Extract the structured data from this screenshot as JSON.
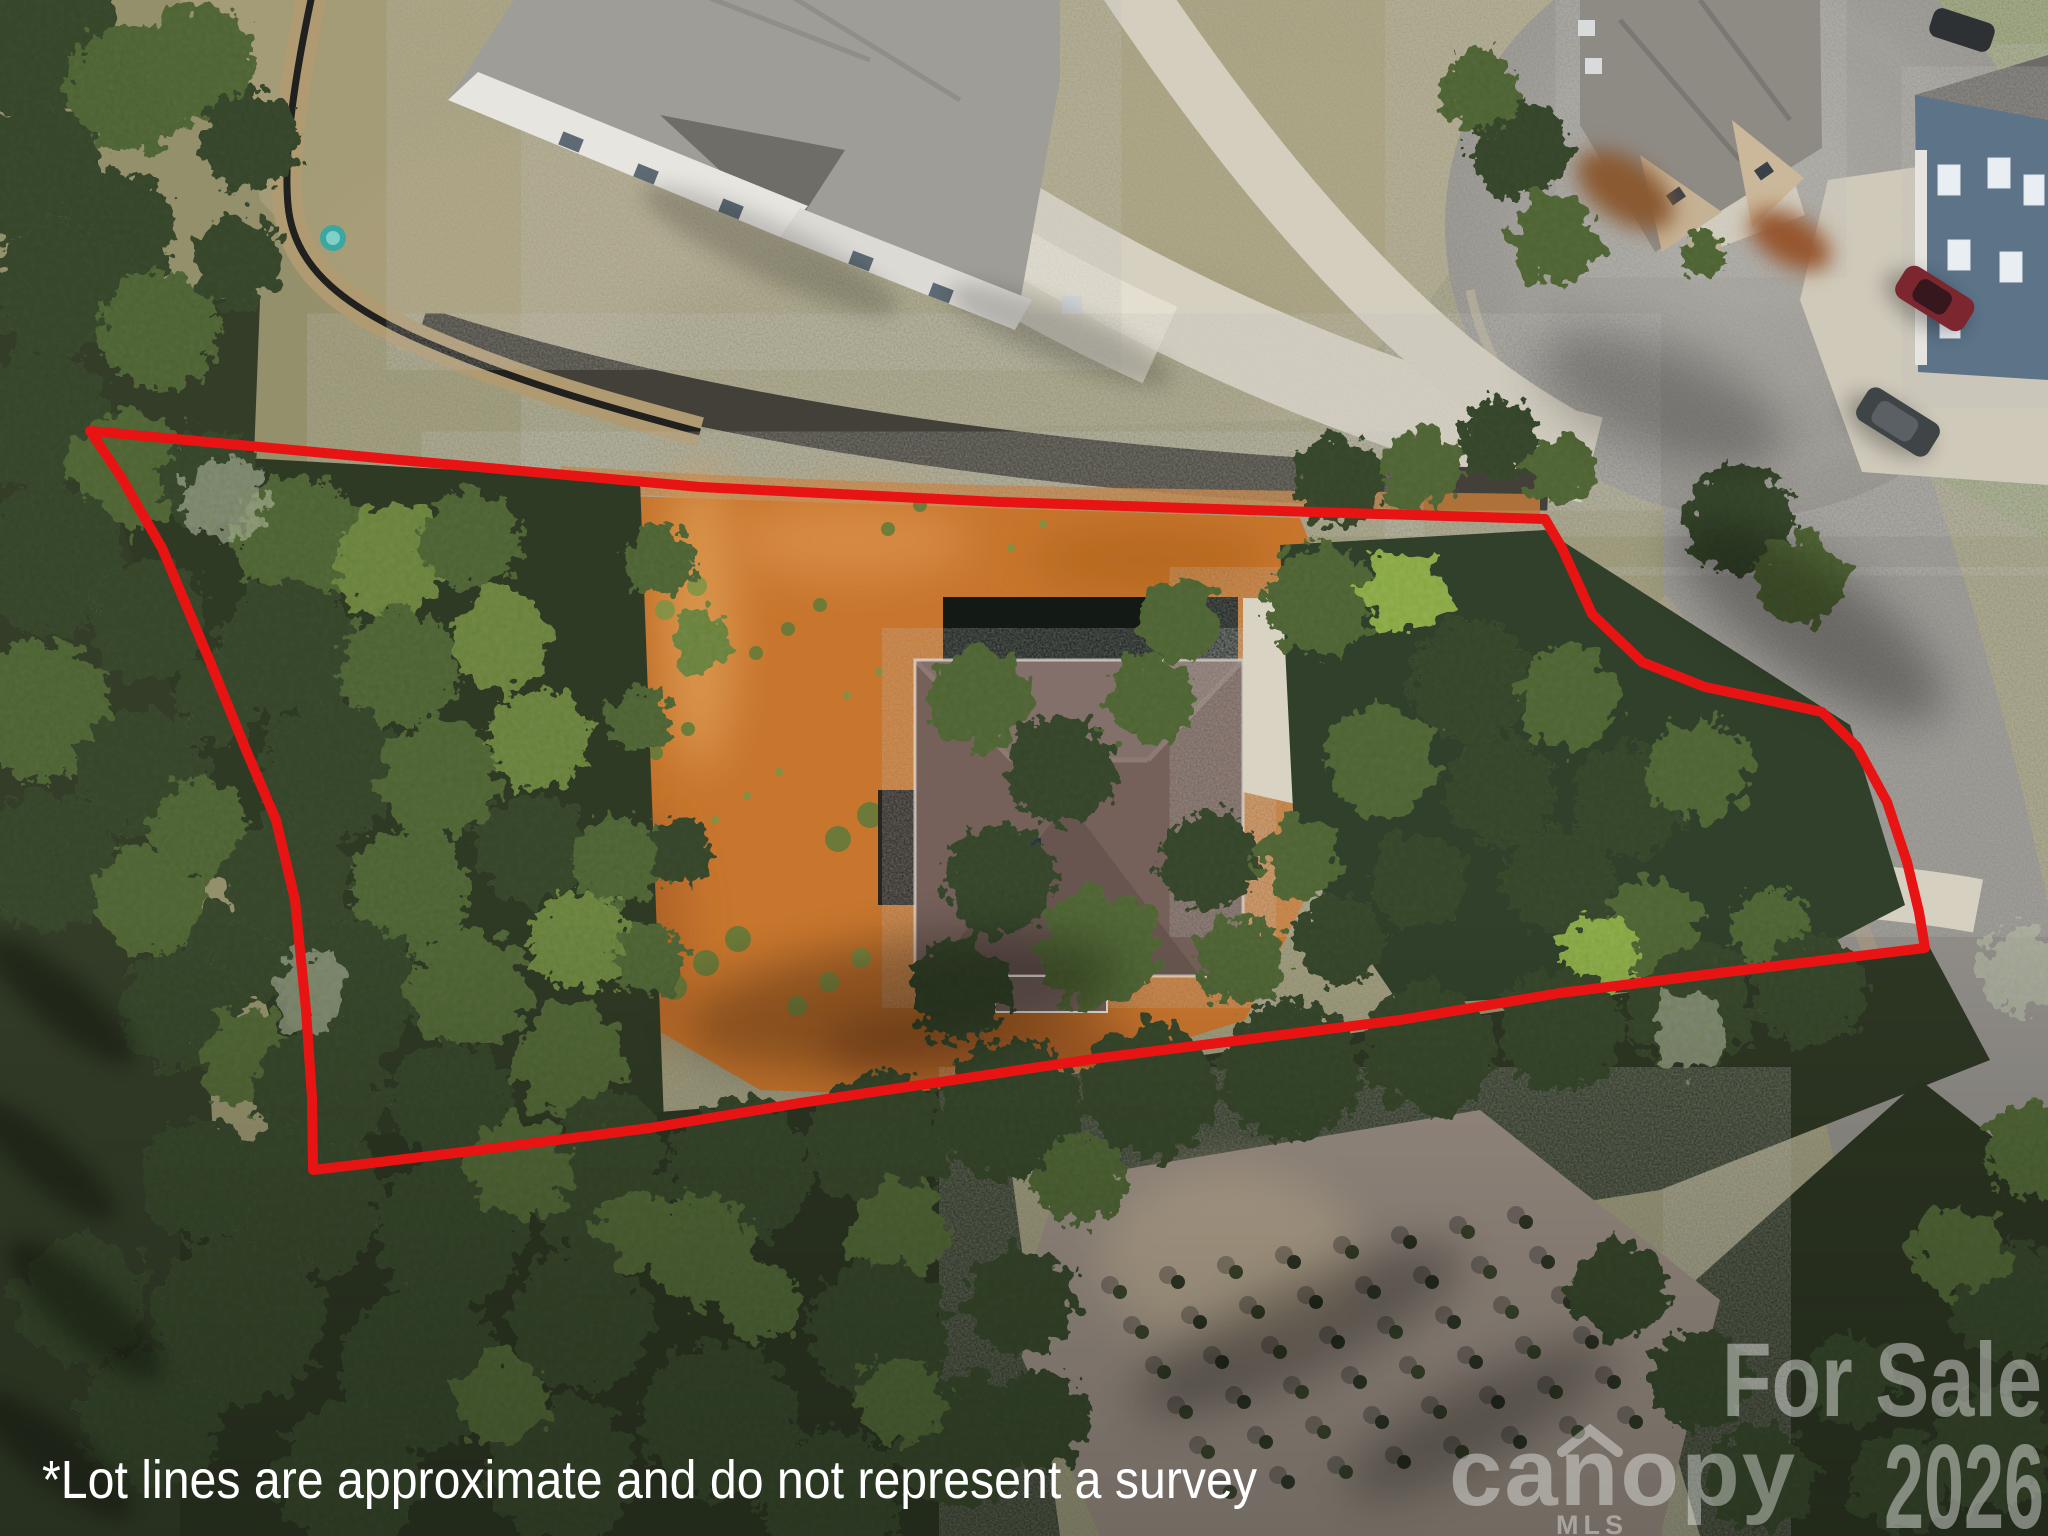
{
  "photo": {
    "kind": "aerial drone photo of a residential homesite",
    "disclaimer": "*Lot lines are approximate and do not represent a survey"
  },
  "watermarks": {
    "for_sale": "For Sale",
    "year": "2026",
    "brand": "canopy",
    "brand_sub": "MLS"
  },
  "lot_line": {
    "color": "#e81414",
    "stroke_width": 10,
    "points": "90,431 400,460 700,487 1000,502 1280,511 1545,519 1562,548 1592,614 1642,662 1705,687 1772,701 1822,712 1857,747 1887,802 1907,862 1919,912 1925,948 1727,972 1560,993 1400,1020 1100,1058 800,1103 650,1128 480,1150 313,1170 312,1098 306,1010 295,900 276,820 246,750 211,664 162,548 121,477"
  },
  "palette": {
    "lawn": "#9e9874",
    "forest_dark": "#3b4930",
    "forest_mid": "#57693d",
    "dirt_orange": "#c8762f",
    "asphalt": "#918e8a",
    "concrete": "#d6d0c2",
    "subject_roof": "#74605a",
    "neighbor_roof_gray": "#9f9d98",
    "disclaimer_text": "#ffffff",
    "watermark_text": "#ffffff"
  }
}
